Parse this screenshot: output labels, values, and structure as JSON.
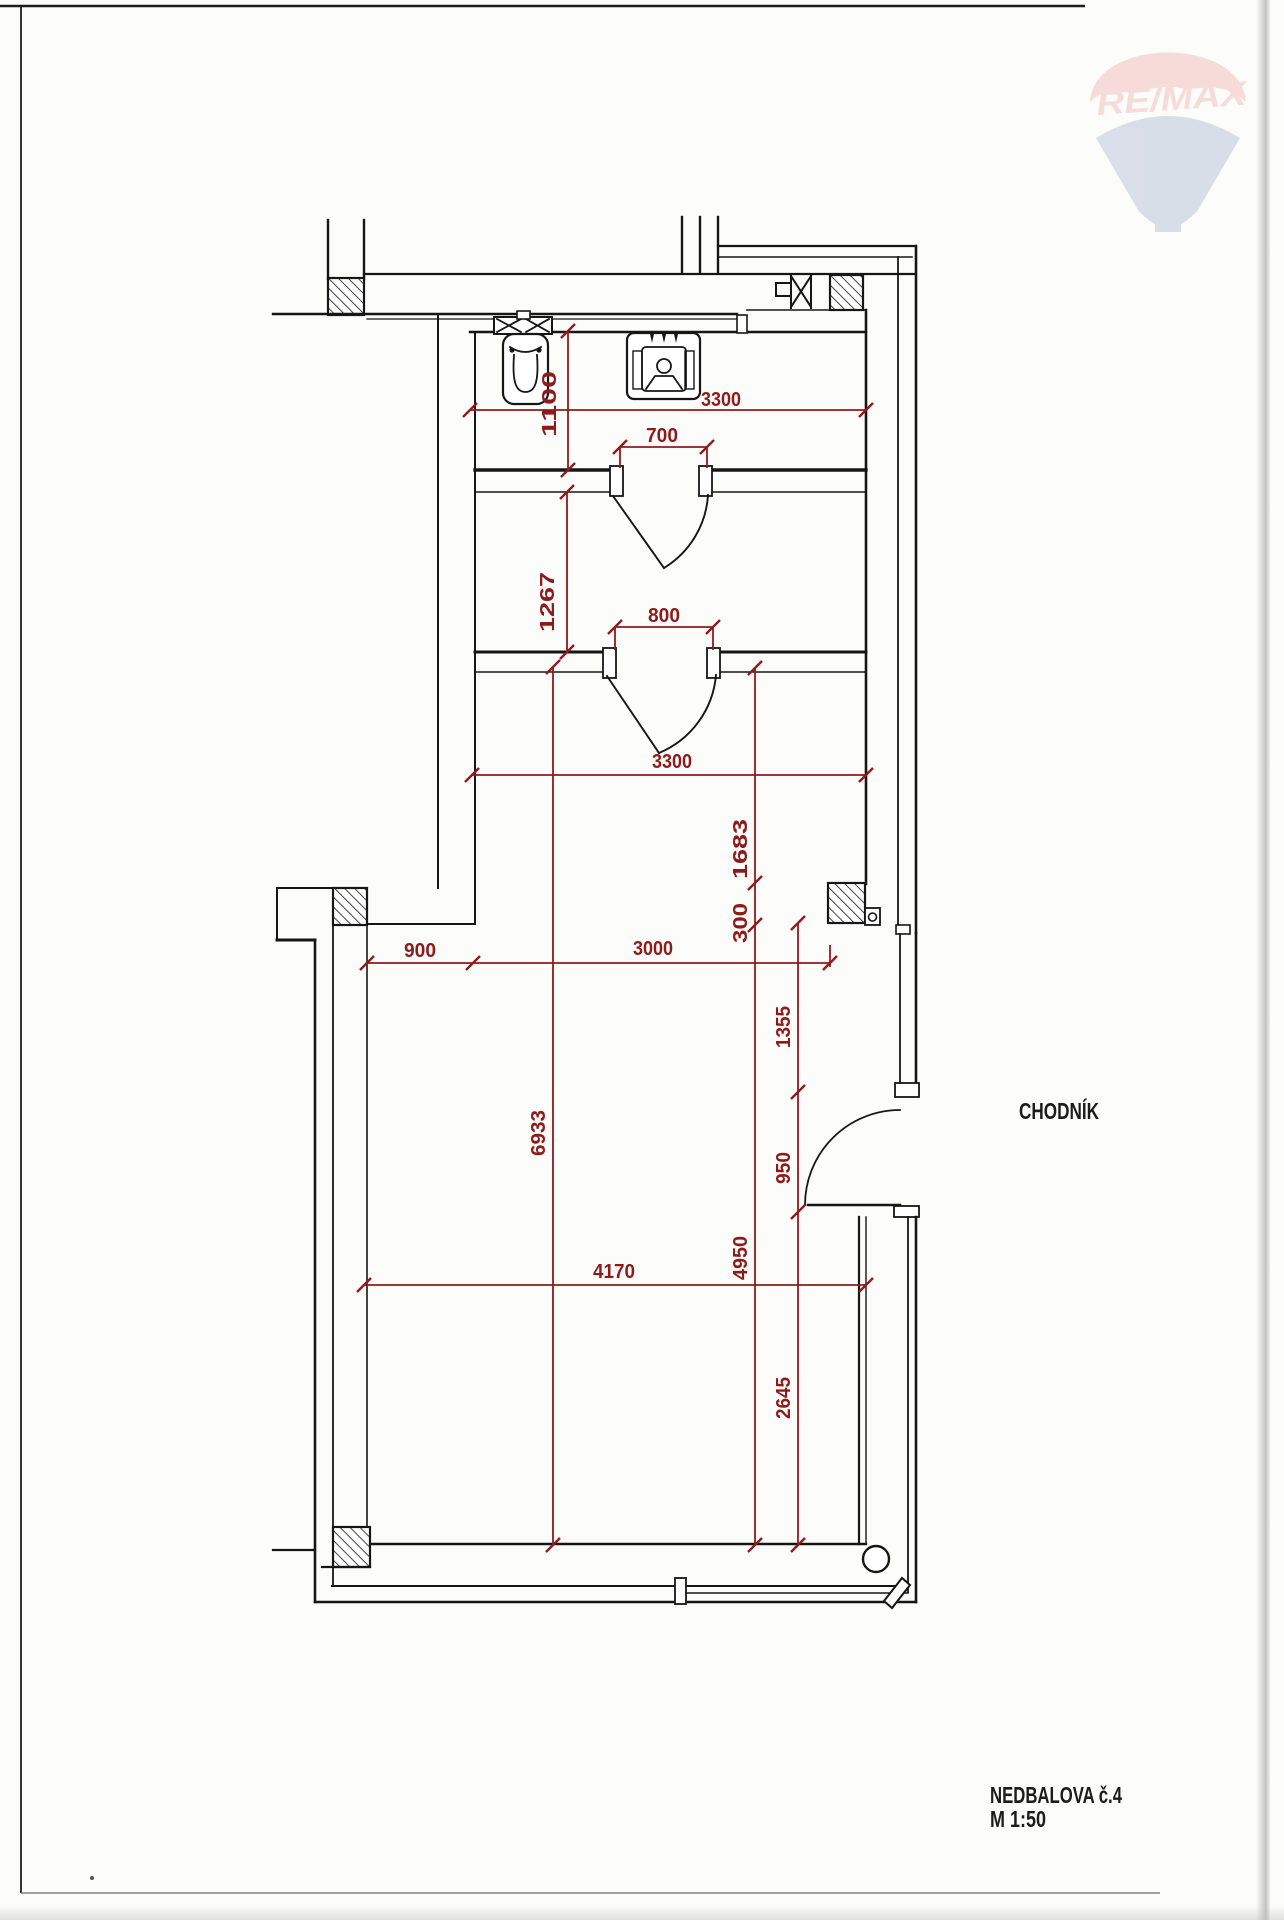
{
  "labels": {
    "corridor": "CHODNÍK",
    "title": "NEDBALOVA č.4",
    "scale": "M 1:50"
  },
  "watermark": {
    "brand": "RE/MAX",
    "red": "#e2413f",
    "blue": "#2e4f92"
  },
  "dims": {
    "d1100": "1100",
    "d3300a": "3300",
    "d700": "700",
    "d1267": "1267",
    "d800": "800",
    "d3300b": "3300",
    "d1683": "1683",
    "d300": "300",
    "d900": "900",
    "d3000": "3000",
    "d6933": "6933",
    "d1355": "1355",
    "d950": "950",
    "d4950": "4950",
    "d4170": "4170",
    "d2645": "2645"
  },
  "colors": {
    "dimension_red": "#8e1b1b",
    "ink": "#161616"
  }
}
